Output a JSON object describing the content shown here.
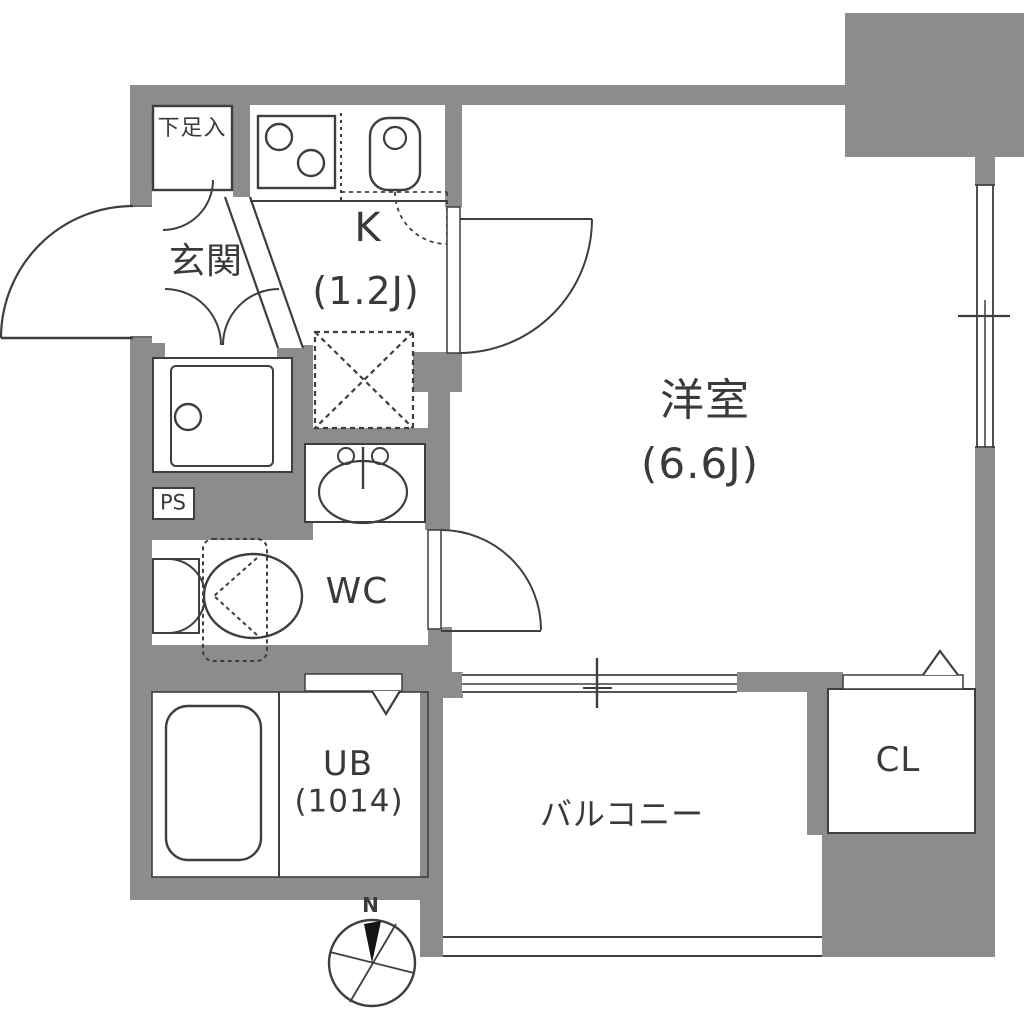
{
  "title": "1K apartment floor plan",
  "colors": {
    "wall": "#8c8c8c",
    "line": "#3e3e3e",
    "text": "#3a3a3a",
    "bg": "#ffffff"
  },
  "rooms": {
    "shoe_cabinet": {
      "label": "下足入"
    },
    "entrance": {
      "label": "玄関"
    },
    "kitchen": {
      "label": "K",
      "size": "(1.2J)"
    },
    "western_room": {
      "label": "洋室",
      "size": "(6.6J)"
    },
    "wc": {
      "label": "WC"
    },
    "unit_bath": {
      "label": "UB",
      "size": "(1014)"
    },
    "closet": {
      "label": "CL"
    },
    "balcony": {
      "label": "バルコニー"
    },
    "pipe_space": {
      "label": "PS"
    }
  },
  "compass": {
    "north_label": "N"
  }
}
